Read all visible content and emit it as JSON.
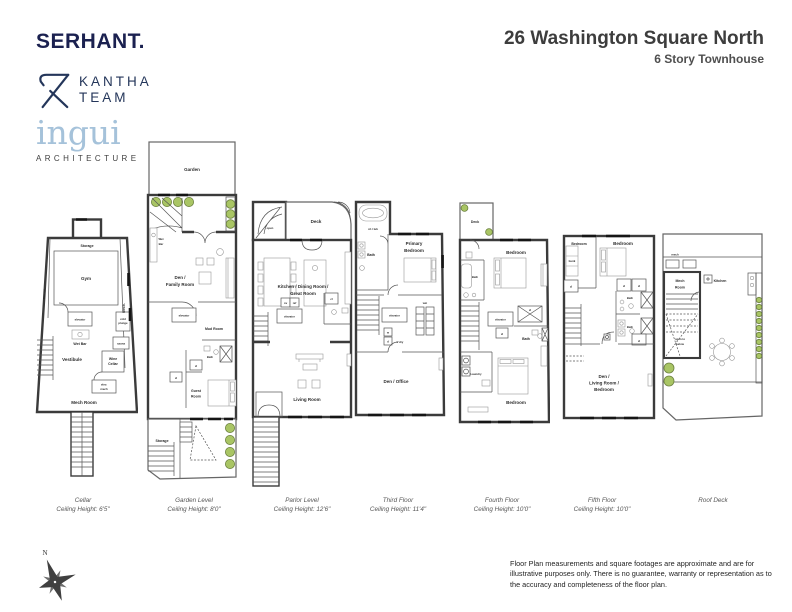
{
  "header": {
    "serhant_logo": "SERHANT.",
    "kantha_line1": "KANTHA",
    "kantha_line2": "TEAM",
    "ingui_logo": "ingui",
    "ingui_subtitle": "ARCHITECTURE",
    "title": "26 Washington Square North",
    "subtitle": "6 Story Townhouse"
  },
  "floors": [
    {
      "name": "Cellar",
      "ceiling": "Ceiling Height: 6'5\"",
      "rooms": {
        "storage_top": "Storage",
        "gym": "Gym",
        "storage_side": "Storage",
        "mech_side": "Mech.",
        "elevator": "elevator",
        "cold_plunge_1": "cold",
        "cold_plunge_2": "plunge",
        "wet_bar": "Wet Bar",
        "sauna": "sauna",
        "vestibule": "Vestibule",
        "wine_cellar_1": "Wine",
        "wine_cellar_2": "Cellar",
        "elev_mech_1": "elev.",
        "elev_mech_2": "mech",
        "mech_room": "Mech Room"
      }
    },
    {
      "name": "Garden Level",
      "ceiling": "Ceiling Height: 8'0\"",
      "rooms": {
        "garden": "Garden",
        "wet_bar_1": "Wet",
        "wet_bar_2": "Bar",
        "den_family_1": "Den /",
        "den_family_2": "Family Room",
        "elevator": "elevator",
        "mud_room": "Mud Room",
        "bath": "Bath",
        "closet_1": "cl",
        "closet_2": "cl",
        "guest_room_1": "Guest",
        "guest_room_2": "Room",
        "storage": "Storage"
      }
    },
    {
      "name": "Parlor Level",
      "ceiling": "Ceiling Height: 12'6\"",
      "rooms": {
        "open": "open",
        "deck": "Deck",
        "kitchen_1": "Kitchen / Dining Room /",
        "kitchen_2": "Great Room",
        "oven": "ov",
        "ref": "ref",
        "elevator": "elevator",
        "closet": "cl",
        "living_room": "Living Room"
      }
    },
    {
      "name": "Third Floor",
      "ceiling": "Ceiling Height: 11'4\"",
      "rooms": {
        "sh_tub": "sh / tub",
        "bath": "Bath",
        "primary_1": "Primary",
        "primary_2": "Bedroom",
        "wic": "wic",
        "elevator": "elevator",
        "washer": "w",
        "dryer": "d",
        "laundry": "L'dry",
        "den_office": "Den / Office"
      }
    },
    {
      "name": "Fourth Floor",
      "ceiling": "Ceiling Height: 10'0\"",
      "rooms": {
        "deck": "Deck",
        "bedroom_top": "Bedroom",
        "bath_left": "Bath",
        "elevator": "elevator",
        "closet_1": "cl",
        "closet_2": "cl",
        "bath_right": "Bath",
        "laundry": "Laundry",
        "bedroom_bottom": "Bedroom"
      }
    },
    {
      "name": "Fifth Floor",
      "ceiling": "Ceiling Height: 10'0\"",
      "rooms": {
        "bedroom_left": "Bedroom",
        "bedroom_right": "Bedroom",
        "bunk": "bunk",
        "closet_1": "cl",
        "closet_2": "cl",
        "closet_3": "cl",
        "closet_4": "cl",
        "bath_upper": "Bath",
        "bath_lower": "Bath",
        "den_1": "Den /",
        "den_2": "Living Room /",
        "den_3": "Bedroom"
      }
    },
    {
      "name": "Roof Deck",
      "ceiling": "",
      "rooms": {
        "mech": "mech",
        "mech_room_1": "Mech",
        "mech_room_2": "Room",
        "kitchen": "Kitchen",
        "open_below_1": "open to",
        "open_below_2": "below"
      }
    }
  ],
  "footer": {
    "compass_north": "N",
    "disclaimer": "Floor Plan measurements and square footages are approximate and are for illustrative purposes only. There is no guarantee, warranty or representation as to the accuracy and completeness of the floor plan."
  }
}
